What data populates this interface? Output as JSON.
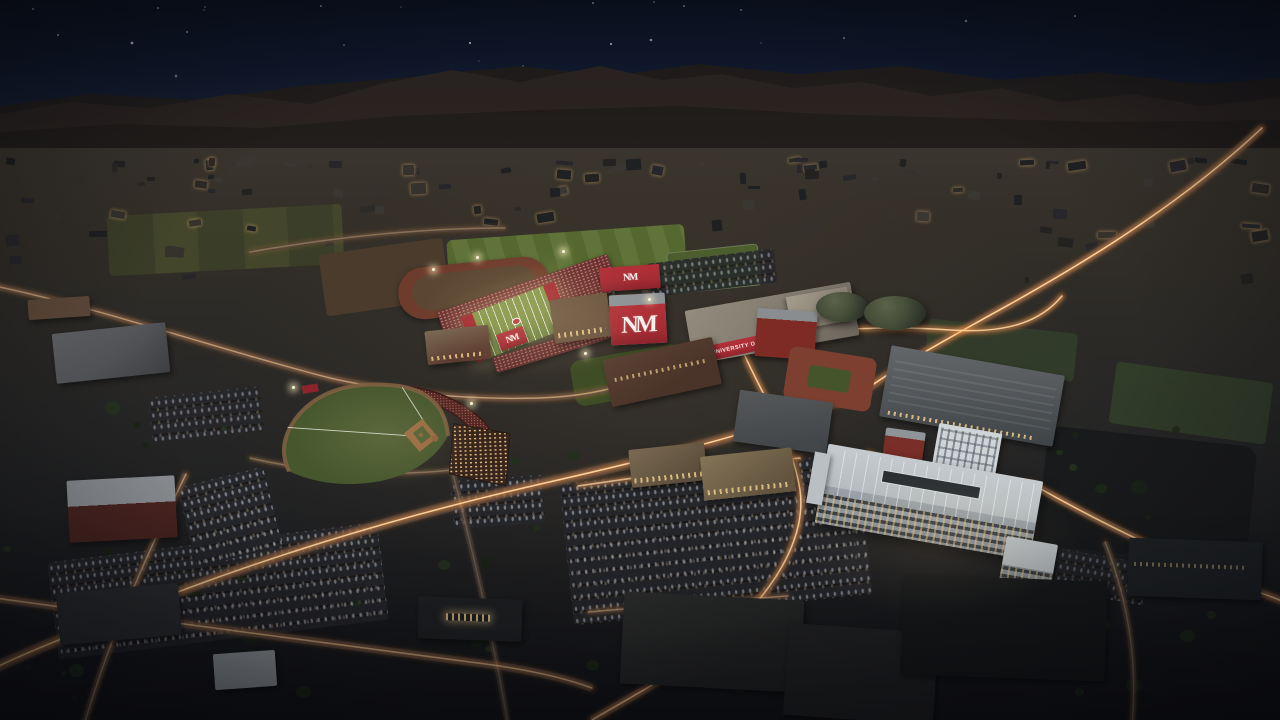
{
  "scene": {
    "setting": "aerial-dusk-campus-rendering",
    "signage": {
      "university_banner": "THE UNIVERSITY OF NEW MEXICO",
      "monogram": "NM"
    },
    "colors": {
      "skyTop": "#0c1322",
      "mountain": "#2c2522",
      "mountainFar": "#221e1d",
      "plainLo": "#141518",
      "cherry": "#a62c34",
      "cherryDark": "#7e2b26",
      "fieldGreen": "#7e9148",
      "fieldDark": "#3f4d26",
      "trackBrown": "#6e3c2c",
      "baseballGreen": "#46572d",
      "infieldTan": "#96683f",
      "crowdRed": "#5c2722",
      "trailGlow": "#ff9a45",
      "trailCore": "#ffd9a4",
      "garage": "#b6bcbf",
      "asphalt": "#26272b",
      "warmWindow": "#e8c27a"
    },
    "landmarks": [
      "night-sky",
      "mountain-ridge",
      "desert-plain",
      "practice-fields",
      "running-track",
      "football-stadium",
      "monogram-wall",
      "north-scoreboard",
      "university-banner-building",
      "indoor-practice-domes",
      "training-track-courtyard",
      "baseball-stadium",
      "parking-garage",
      "office-buildings",
      "parking-lots",
      "street-light-trails"
    ]
  }
}
